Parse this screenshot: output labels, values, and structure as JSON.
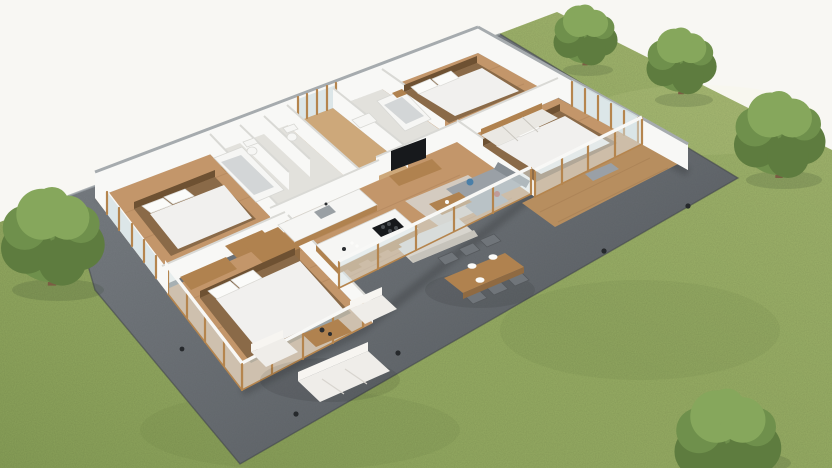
{
  "scene": {
    "type": "3d-isometric-floor-plan-render",
    "view": "aerial dollhouse cutaway of a single-storey house, no text labels",
    "setting": {
      "background": "white studio backdrop",
      "ground": "large green lawn",
      "terrace": "dark gray paved patio wrapping around the house",
      "trees_on_lawn": 5
    },
    "house": {
      "style": "roofless cutaway model, white walls, wood floors, wood-framed glazing",
      "rooms": [
        {
          "name": "bedroom-left",
          "floor": "wood",
          "furniture": [
            "double bed with white duvet and two pillows",
            "wooden headboard",
            "wardrobe",
            "nightstand"
          ]
        },
        {
          "name": "bathroom-main",
          "floor": "light tile",
          "furniture": [
            "bathtub",
            "toilet",
            "separate wc with toilet"
          ]
        },
        {
          "name": "entry-hall",
          "floor": "wood",
          "furniture": []
        },
        {
          "name": "bathroom-ensuite",
          "floor": "light tile",
          "furniture": [
            "bathtub",
            "vanity"
          ]
        },
        {
          "name": "bedroom-top",
          "floor": "wood",
          "furniture": [
            "double bed with white duvet and two pillows",
            "nightstand"
          ]
        },
        {
          "name": "bedroom-right",
          "floor": "wood",
          "furniture": [
            "double bed with white duvet and two pillows",
            "sliding-door wardrobe",
            "bench"
          ]
        },
        {
          "name": "living-room",
          "floor": "wood",
          "furniture": [
            "gray corner sofa with blue and red cushions",
            "cream sofa",
            "wooden coffee table",
            "light area rug",
            "tv console",
            "wall-mounted tv"
          ]
        },
        {
          "name": "kitchen-dining",
          "floor": "wood",
          "furniture": [
            "kitchen island with black cooktop",
            "wall counter with sink",
            "tall wooden cabinets",
            "three bar stools"
          ]
        },
        {
          "name": "bedroom-bottom",
          "floor": "wood",
          "feature": "floor-to-ceiling glass walls on two sides",
          "furniture": [
            "double bed with white duvet and two pillows",
            "closet",
            "dark bench"
          ]
        }
      ],
      "deck": "small w ood-plank deck outside bedroom-right"
    },
    "outdoor": {
      "patio_furniture": [
        "white three-seat outdoor sofa",
        "two white outdoor armchairs",
        "wooden outdoor coffee table",
        "wooden dining table with six gray chairs and three white place settings"
      ],
      "details": [
        "small dark garden spotlights on patio and lawn edge"
      ],
      "trees": [
        {
          "position": "left edge of lawn",
          "size": "large"
        },
        {
          "position": "top, behind house",
          "size": "medium"
        },
        {
          "position": "upper right",
          "size": "medium"
        },
        {
          "position": "right side",
          "size": "large"
        },
        {
          "position": "bottom right of lawn",
          "size": "large shrub"
        }
      ]
    }
  },
  "colors": {
    "background": "#f8f7f3",
    "grass": "#93aa60",
    "patio": "#656b71",
    "patioEdge": "#3f4449",
    "patioLightEdge": "#9aa0a5",
    "wallFace": "#f8f8f6",
    "wallTop": "#a6abae",
    "wallInnerTop": "#d9d9d5",
    "woodFloor": "#c3966a",
    "hallFloor": "#cda87a",
    "deckWood": "#b78e5f",
    "tileFloor": "#e2e1dc",
    "glass": "#d7e3e5",
    "frameWood": "#b5854e",
    "bedBase": "#8a6a48",
    "bedLinen": "#f1f0ee",
    "pillow": "#fbfbf9",
    "headboard": "#6e5132",
    "sofaGray": "#9aa0a6",
    "sofaDark": "#868d93",
    "sofaCream": "#d8d5ce",
    "creamDark": "#c6c3bb",
    "rug": "#d6d3cc",
    "woodFurniture": "#b0824f",
    "woodDark": "#8f6a42",
    "dark": "#17191c",
    "steel": "#9aa0a4",
    "tubInner": "#d3d6d7",
    "white": "#f6f6f4",
    "closetWhite": "#eae8e3",
    "chairGray": "#70757a",
    "chairDark": "#55595d",
    "outWhite": "#efede9",
    "accentBlue": "#4a7fa8",
    "accentRed": "#a8524a",
    "treeGreenDark": "#5e7c3f",
    "treeGreen": "#6f904c",
    "treeGreenLight": "#86a75c",
    "trunk": "#7b5d43",
    "shadowGreen": "#31402a",
    "lightDot": "#26292c"
  }
}
